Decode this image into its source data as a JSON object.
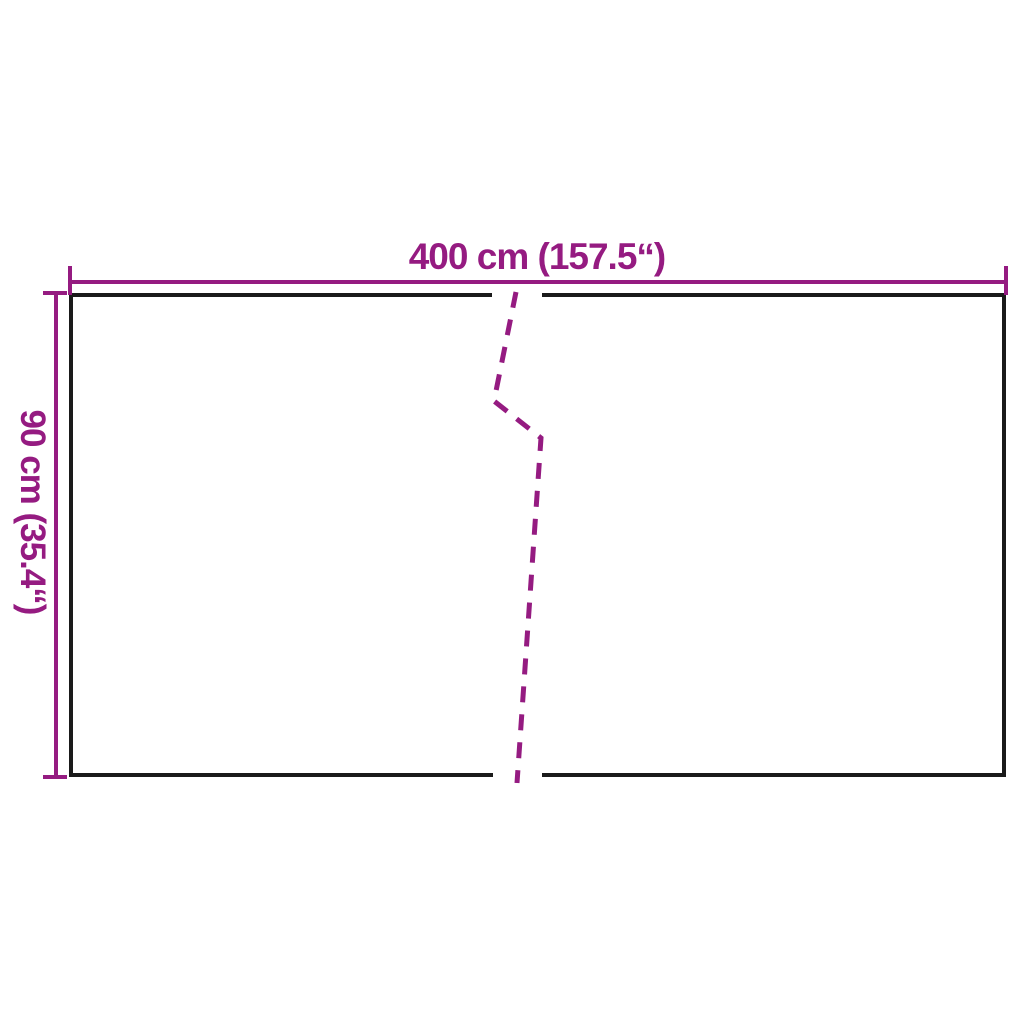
{
  "diagram": {
    "type": "product-dimension-diagram",
    "width_label": "400 cm (157.5“)",
    "height_label": "90 cm (35.4“)"
  },
  "colors": {
    "dimension_accent": "#951b81",
    "panel_outline": "#1a1a1a",
    "background": "#ffffff"
  }
}
